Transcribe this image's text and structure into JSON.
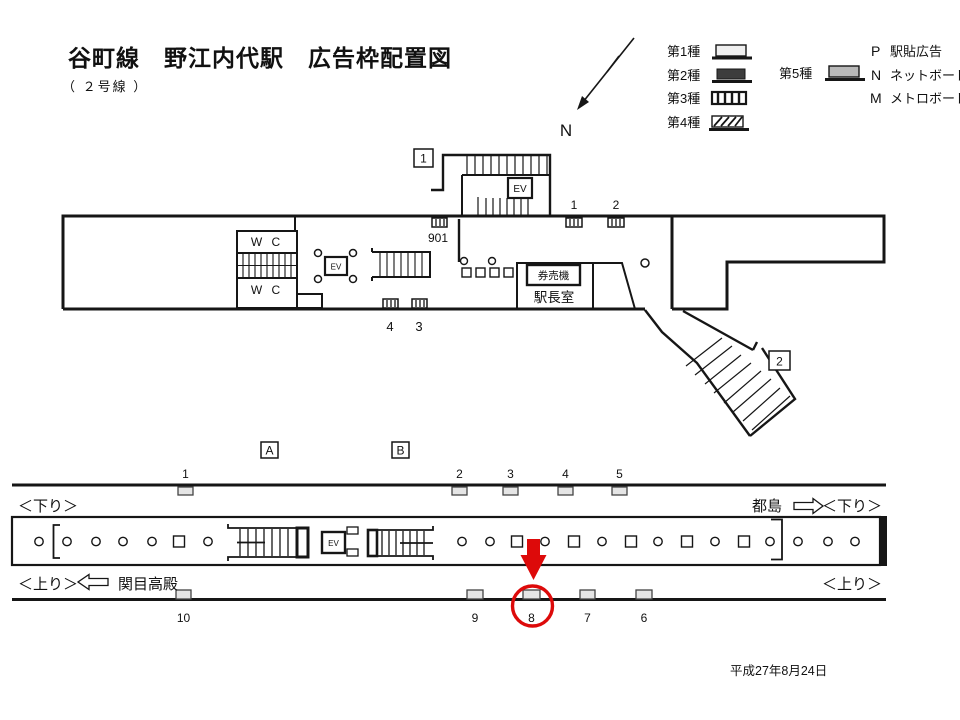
{
  "title": {
    "main": "谷町線　野江内代駅　広告枠配置図",
    "subtitle": "（ ２号線 ）"
  },
  "compass": {
    "label": "N"
  },
  "legend": {
    "type1": "第1種",
    "type2": "第2種",
    "type3": "第3種",
    "type4": "第4種",
    "type5": "第5種",
    "codes": [
      {
        "code": "P",
        "label": "駅貼広告"
      },
      {
        "code": "N",
        "label": "ネットボード"
      },
      {
        "code": "M",
        "label": "メトロボード"
      }
    ]
  },
  "concourse": {
    "exit1": "1",
    "exit2": "2",
    "wc_upper": "W C",
    "wc_lower": "W C",
    "ev_exit": "EV",
    "ev_hall": "EV",
    "ticket_machine": "券売機",
    "station_master_office": "駅長室",
    "positions": {
      "p901": "901",
      "p1": "1",
      "p2": "2",
      "p3": "3",
      "p4": "4"
    }
  },
  "platform": {
    "marker_a": "A",
    "marker_b": "B",
    "ev": "EV",
    "top_positions": [
      "1",
      "2",
      "3",
      "4",
      "5"
    ],
    "bottom_positions": [
      "10",
      "9",
      "8",
      "7",
      "6"
    ],
    "highlighted_position": "8",
    "down_label_left": "＜下り＞",
    "down_label_right": "＜下り＞",
    "up_label_left": "＜上り＞",
    "up_label_right": "＜上り＞",
    "station_right": "都島",
    "station_left": "関目高殿"
  },
  "footer": {
    "date": "平成27年8月24日"
  },
  "colors": {
    "highlight": "#dd0a0a"
  }
}
